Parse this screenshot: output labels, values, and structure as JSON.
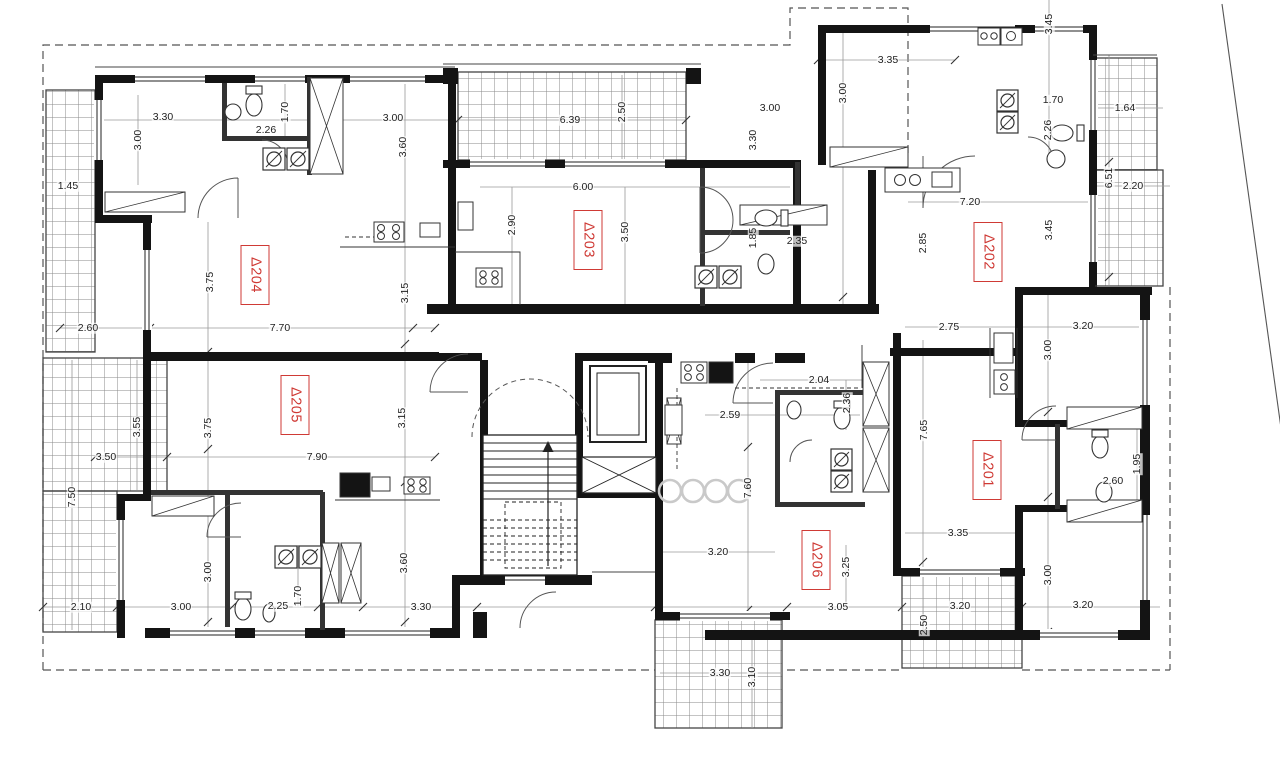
{
  "drawing": {
    "kind": "architectural floor plan",
    "units_note": "dimensions in metres"
  },
  "colors": {
    "apartment_label_red": "#cf3a35",
    "wall_black": "#141414",
    "dimension_text": "#222222",
    "hatch_gray": "#8a8a8a"
  },
  "apartments": [
    {
      "id": "Δ204"
    },
    {
      "id": "Δ203"
    },
    {
      "id": "Δ202"
    },
    {
      "id": "Δ205"
    },
    {
      "id": "Δ201"
    },
    {
      "id": "Δ206"
    }
  ],
  "dims": [
    {
      "v": "1.45"
    },
    {
      "v": "3.30"
    },
    {
      "v": "2.26"
    },
    {
      "v": "3.00"
    },
    {
      "v": "6.39"
    },
    {
      "v": "3.00"
    },
    {
      "v": "3.35"
    },
    {
      "v": "1.70"
    },
    {
      "v": "1.64"
    },
    {
      "v": "2.20"
    },
    {
      "v": "7.20"
    },
    {
      "v": "6.00"
    },
    {
      "v": "2.35"
    },
    {
      "v": "7.70"
    },
    {
      "v": "2.60"
    },
    {
      "v": "3.50"
    },
    {
      "v": "7.90"
    },
    {
      "v": "2.75"
    },
    {
      "v": "3.20"
    },
    {
      "v": "2.04"
    },
    {
      "v": "2.59"
    },
    {
      "v": "2.60"
    },
    {
      "v": "3.35"
    },
    {
      "v": "3.20"
    },
    {
      "v": "2.10"
    },
    {
      "v": "3.00"
    },
    {
      "v": "2.25"
    },
    {
      "v": "3.30"
    },
    {
      "v": "3.05"
    },
    {
      "v": "3.20"
    },
    {
      "v": "3.20"
    },
    {
      "v": "3.30"
    },
    {
      "v": "3.00"
    },
    {
      "v": "1.70"
    },
    {
      "v": "3.60"
    },
    {
      "v": "3.75"
    },
    {
      "v": "3.15"
    },
    {
      "v": "2.50"
    },
    {
      "v": "3.30"
    },
    {
      "v": "2.90"
    },
    {
      "v": "3.50"
    },
    {
      "v": "1.85"
    },
    {
      "v": "3.45"
    },
    {
      "v": "3.00"
    },
    {
      "v": "2.26"
    },
    {
      "v": "6.51"
    },
    {
      "v": "2.85"
    },
    {
      "v": "3.45"
    },
    {
      "v": "3.00"
    },
    {
      "v": "3.75"
    },
    {
      "v": "3.55"
    },
    {
      "v": "3.15"
    },
    {
      "v": "7.50"
    },
    {
      "v": "7.65"
    },
    {
      "v": "7.60"
    },
    {
      "v": "2.36"
    },
    {
      "v": "1.95"
    },
    {
      "v": "3.00"
    },
    {
      "v": "1.70"
    },
    {
      "v": "3.60"
    },
    {
      "v": "3.00"
    },
    {
      "v": "2.50"
    },
    {
      "v": "3.25"
    },
    {
      "v": "3.10"
    }
  ]
}
